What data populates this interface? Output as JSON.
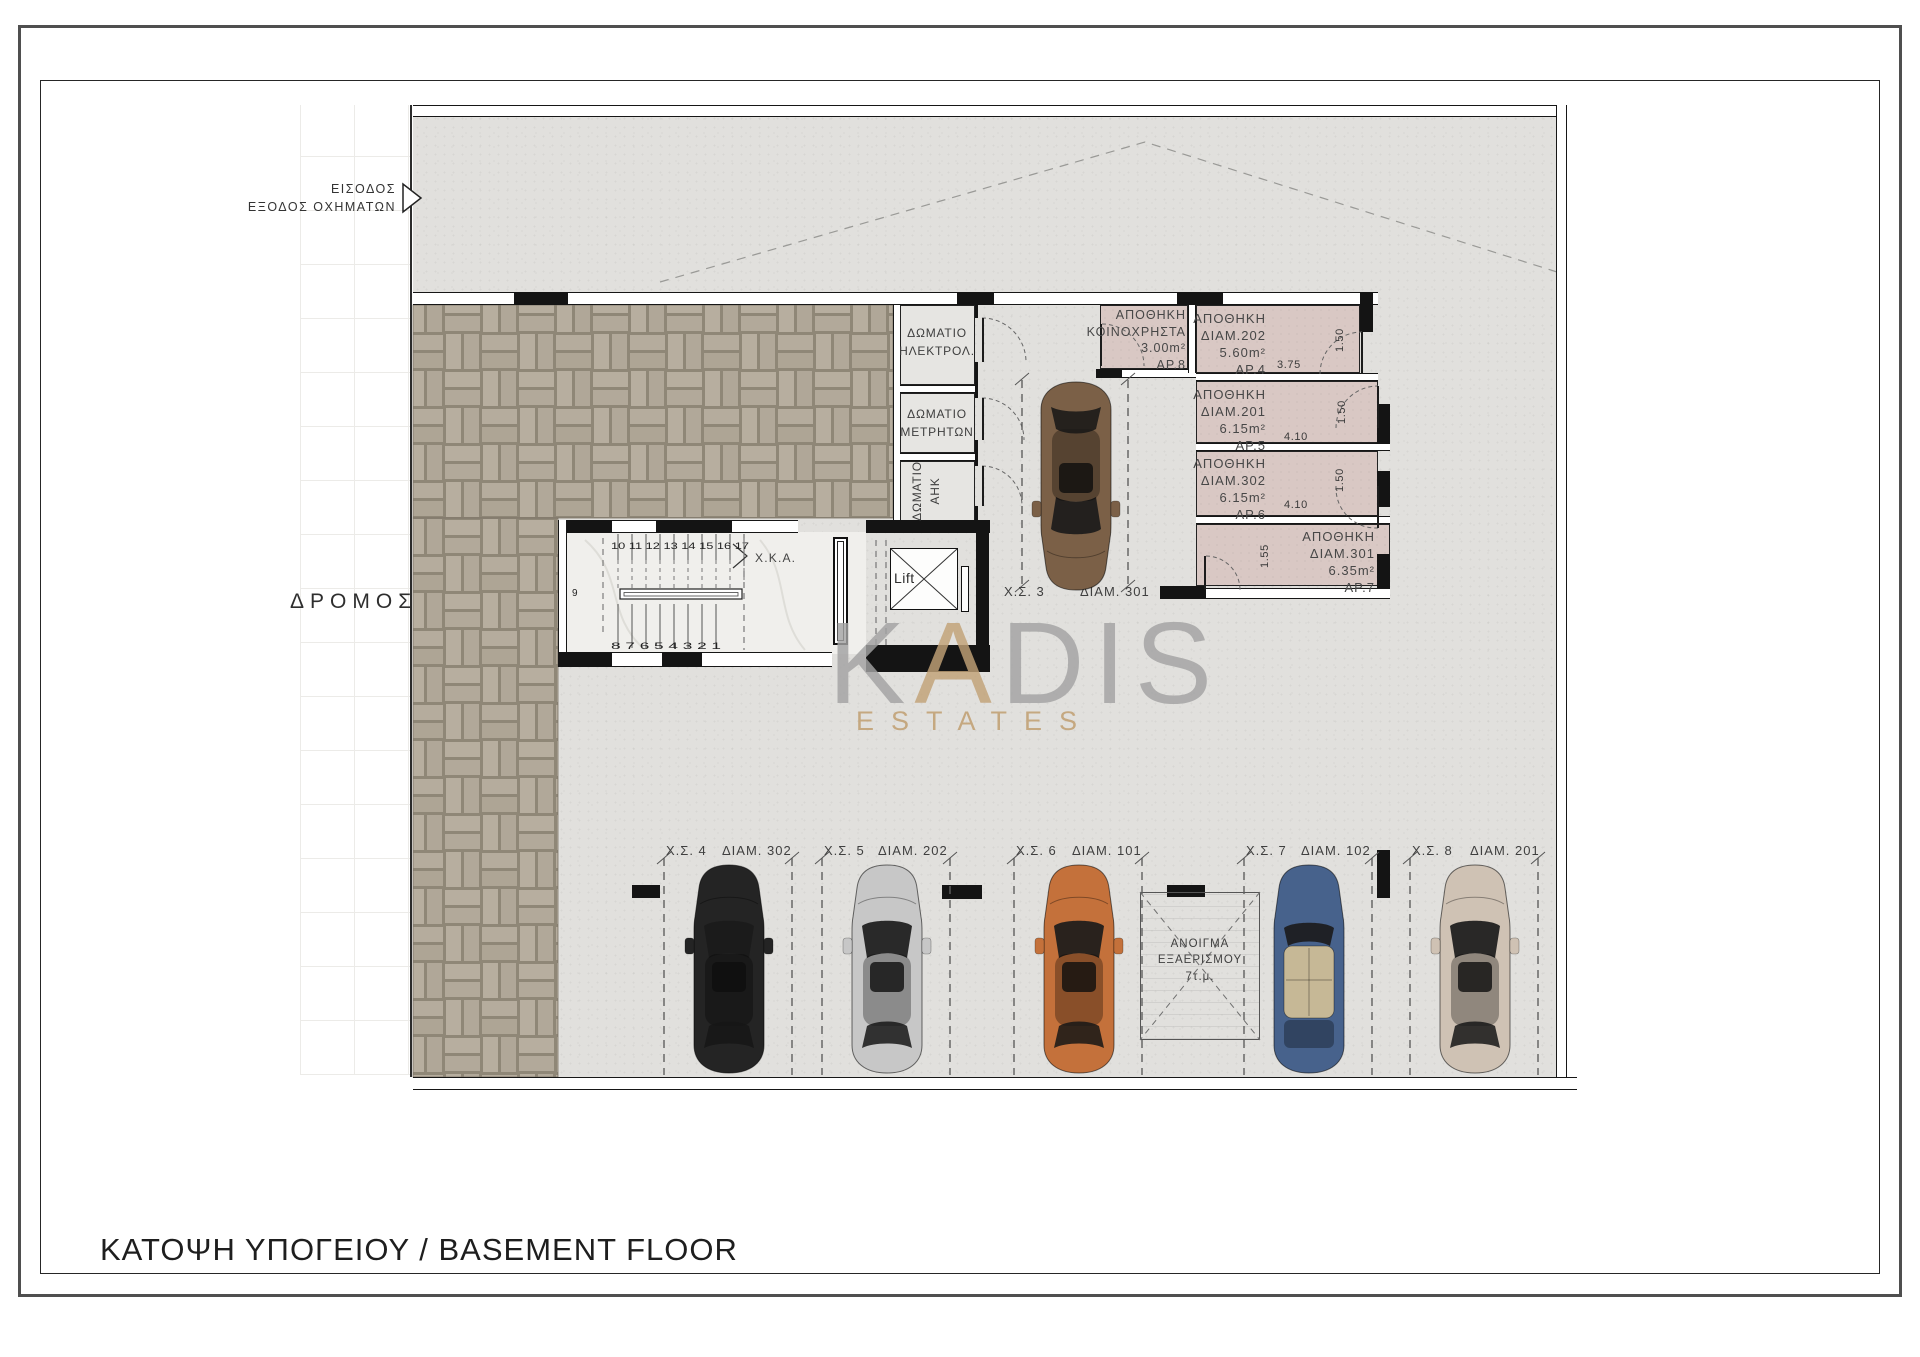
{
  "titles": {
    "sheet_title": "ΚΑΤΟΨΗ ΥΠΟΓΕΙΟΥ  / BASEMENT FLOOR"
  },
  "watermark": {
    "brand_gray_1": "K",
    "brand_accent": "A",
    "brand_gray_2": "DIS",
    "subtitle": "ESTATES"
  },
  "annotations": {
    "entrance": {
      "line1": "ΕΙΣΟΔΟΣ",
      "line2": "ΕΞΟΔΟΣ ΟΧΗΜΑΤΩΝ"
    },
    "road": "ΔΡΟΜΟΣ",
    "corridor": "Χ.Κ.Α.",
    "lift": "Lift",
    "vent": {
      "line1": "ΑΝΟΙΓΜΑ",
      "line2": "ΕΞΑΕΡΙΣΜΟΥ",
      "line3": "7τ.μ."
    }
  },
  "stairs": {
    "upper_numbers": "10 11 12 13 14 15 16 17",
    "mid_number": "9",
    "lower_numbers": "8 7 6 5 4 3 2 1"
  },
  "utility_rooms": [
    {
      "line1": "ΔΩΜΑΤΙΟ",
      "line2": "ΗΛΕΚΤΡΟΛ."
    },
    {
      "line1": "ΔΩΜΑΤΙΟ",
      "line2": "ΜΕΤΡΗΤΩΝ"
    },
    {
      "line1": "ΔΩΜΑΤΙΟ",
      "line2": "ΑΗΚ"
    }
  ],
  "storages": [
    {
      "title": "ΑΠΟΘΗΚΗ",
      "unit": "ΚΟΙΝΟΧΡΗΣΤΑ",
      "area": "3.00m²",
      "number": "ΑΡ.8"
    },
    {
      "title": "ΑΠΟΘΗΚΗ",
      "unit": "ΔΙΑΜ.202",
      "area": "5.60m²",
      "number": "ΑΡ.4",
      "width_dim": "3.75",
      "depth_dim": "1.50"
    },
    {
      "title": "ΑΠΟΘΗΚΗ",
      "unit": "ΔΙΑΜ.201",
      "area": "6.15m²",
      "number": "ΑΡ.5",
      "width_dim": "4.10",
      "depth_dim": "1.50"
    },
    {
      "title": "ΑΠΟΘΗΚΗ",
      "unit": "ΔΙΑΜ.302",
      "area": "6.15m²",
      "number": "ΑΡ.6",
      "width_dim": "4.10",
      "depth_dim": "1.50"
    },
    {
      "title": "ΑΠΟΘΗΚΗ",
      "unit": "ΔΙΑΜ.301",
      "area": "6.35m²",
      "number": "ΑΡ.7",
      "depth_dim": "1.55"
    }
  ],
  "parking_spots": [
    {
      "spot": "Χ.Σ. 3",
      "unit": "ΔΙΑΜ. 301",
      "car_color": "#7b6047"
    },
    {
      "spot": "Χ.Σ. 4",
      "unit": "ΔΙΑΜ. 302",
      "car_color": "#242424"
    },
    {
      "spot": "Χ.Σ. 5",
      "unit": "ΔΙΑΜ. 202",
      "car_color": "#c7c7c7"
    },
    {
      "spot": "Χ.Σ. 6",
      "unit": "ΔΙΑΜ. 101",
      "car_color": "#c4713b"
    },
    {
      "spot": "Χ.Σ. 7",
      "unit": "ΔΙΑΜ. 102",
      "car_color": "#47628c"
    },
    {
      "spot": "Χ.Σ. 8",
      "unit": "ΔΙΑΜ. 201",
      "car_color": "#cfc2b4"
    }
  ],
  "colors": {
    "concrete": "#e1e0dd",
    "paving": "#b6ad9e",
    "paving-joint": "#8f8777",
    "storage": "#d9c8c4",
    "marble": "#f0efec",
    "wall": "#141414",
    "gold": "#c2a277",
    "wmgray": "#a3a3a3"
  }
}
